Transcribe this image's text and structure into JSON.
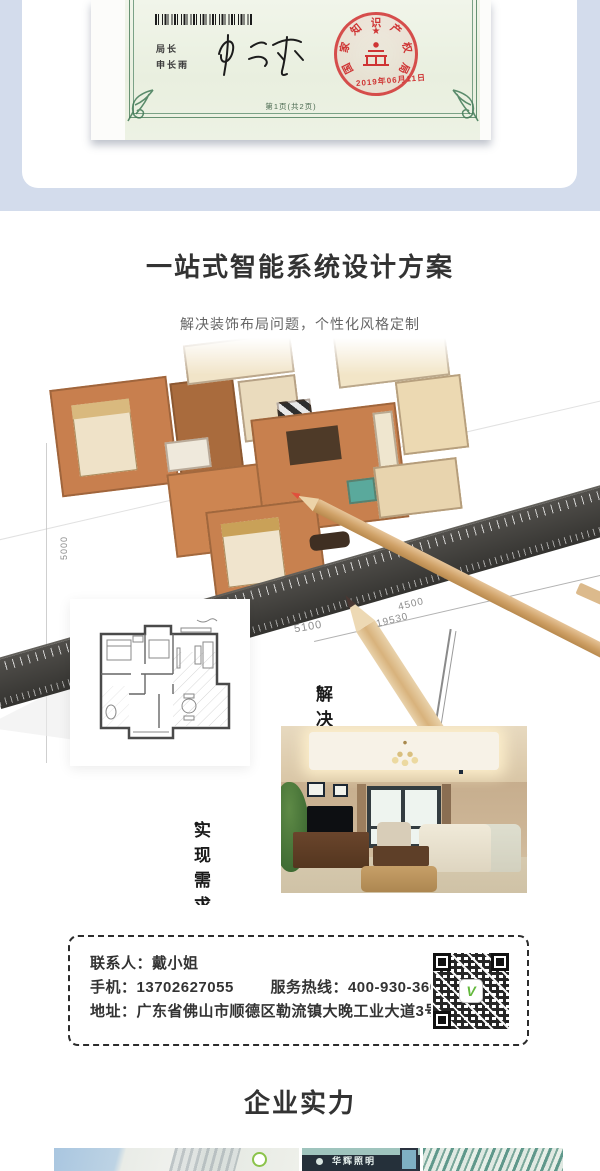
{
  "colors": {
    "top_background": "#d3dcec",
    "seal_red": "#cf3434",
    "qr_logo_green": "#63b83c",
    "heading_text": "#333333",
    "subtitle_text": "#666666"
  },
  "certificate": {
    "director_label": "局长",
    "director_name": "申长雨",
    "signature_name": "申长雨",
    "page_note": "第1页(共2页)",
    "seal": {
      "org": "国家知识产权局",
      "date": "2019年06月11日"
    }
  },
  "solution": {
    "title": "一站式智能系统设计方案",
    "subtitle": "解决装饰布局问题，个性化风格定制",
    "bullet": "•",
    "steps": [
      {
        "label": "解决需求"
      },
      {
        "label": "实现需求"
      }
    ],
    "blueprint_dimensions": [
      "5100",
      "4500",
      "19530",
      "5000"
    ]
  },
  "contact": {
    "person_label": "联系人：",
    "person": "戴小姐",
    "mobile_label": "手机：",
    "mobile": "13702627055",
    "hotline_label": "服务热线：",
    "hotline": "400-930-3600",
    "address_label": "地址：",
    "address": "广东省佛山市顺德区勒流镇大晚工业大道3号"
  },
  "strength": {
    "heading": "企业实力",
    "storefront_sign": "华辉照明"
  }
}
